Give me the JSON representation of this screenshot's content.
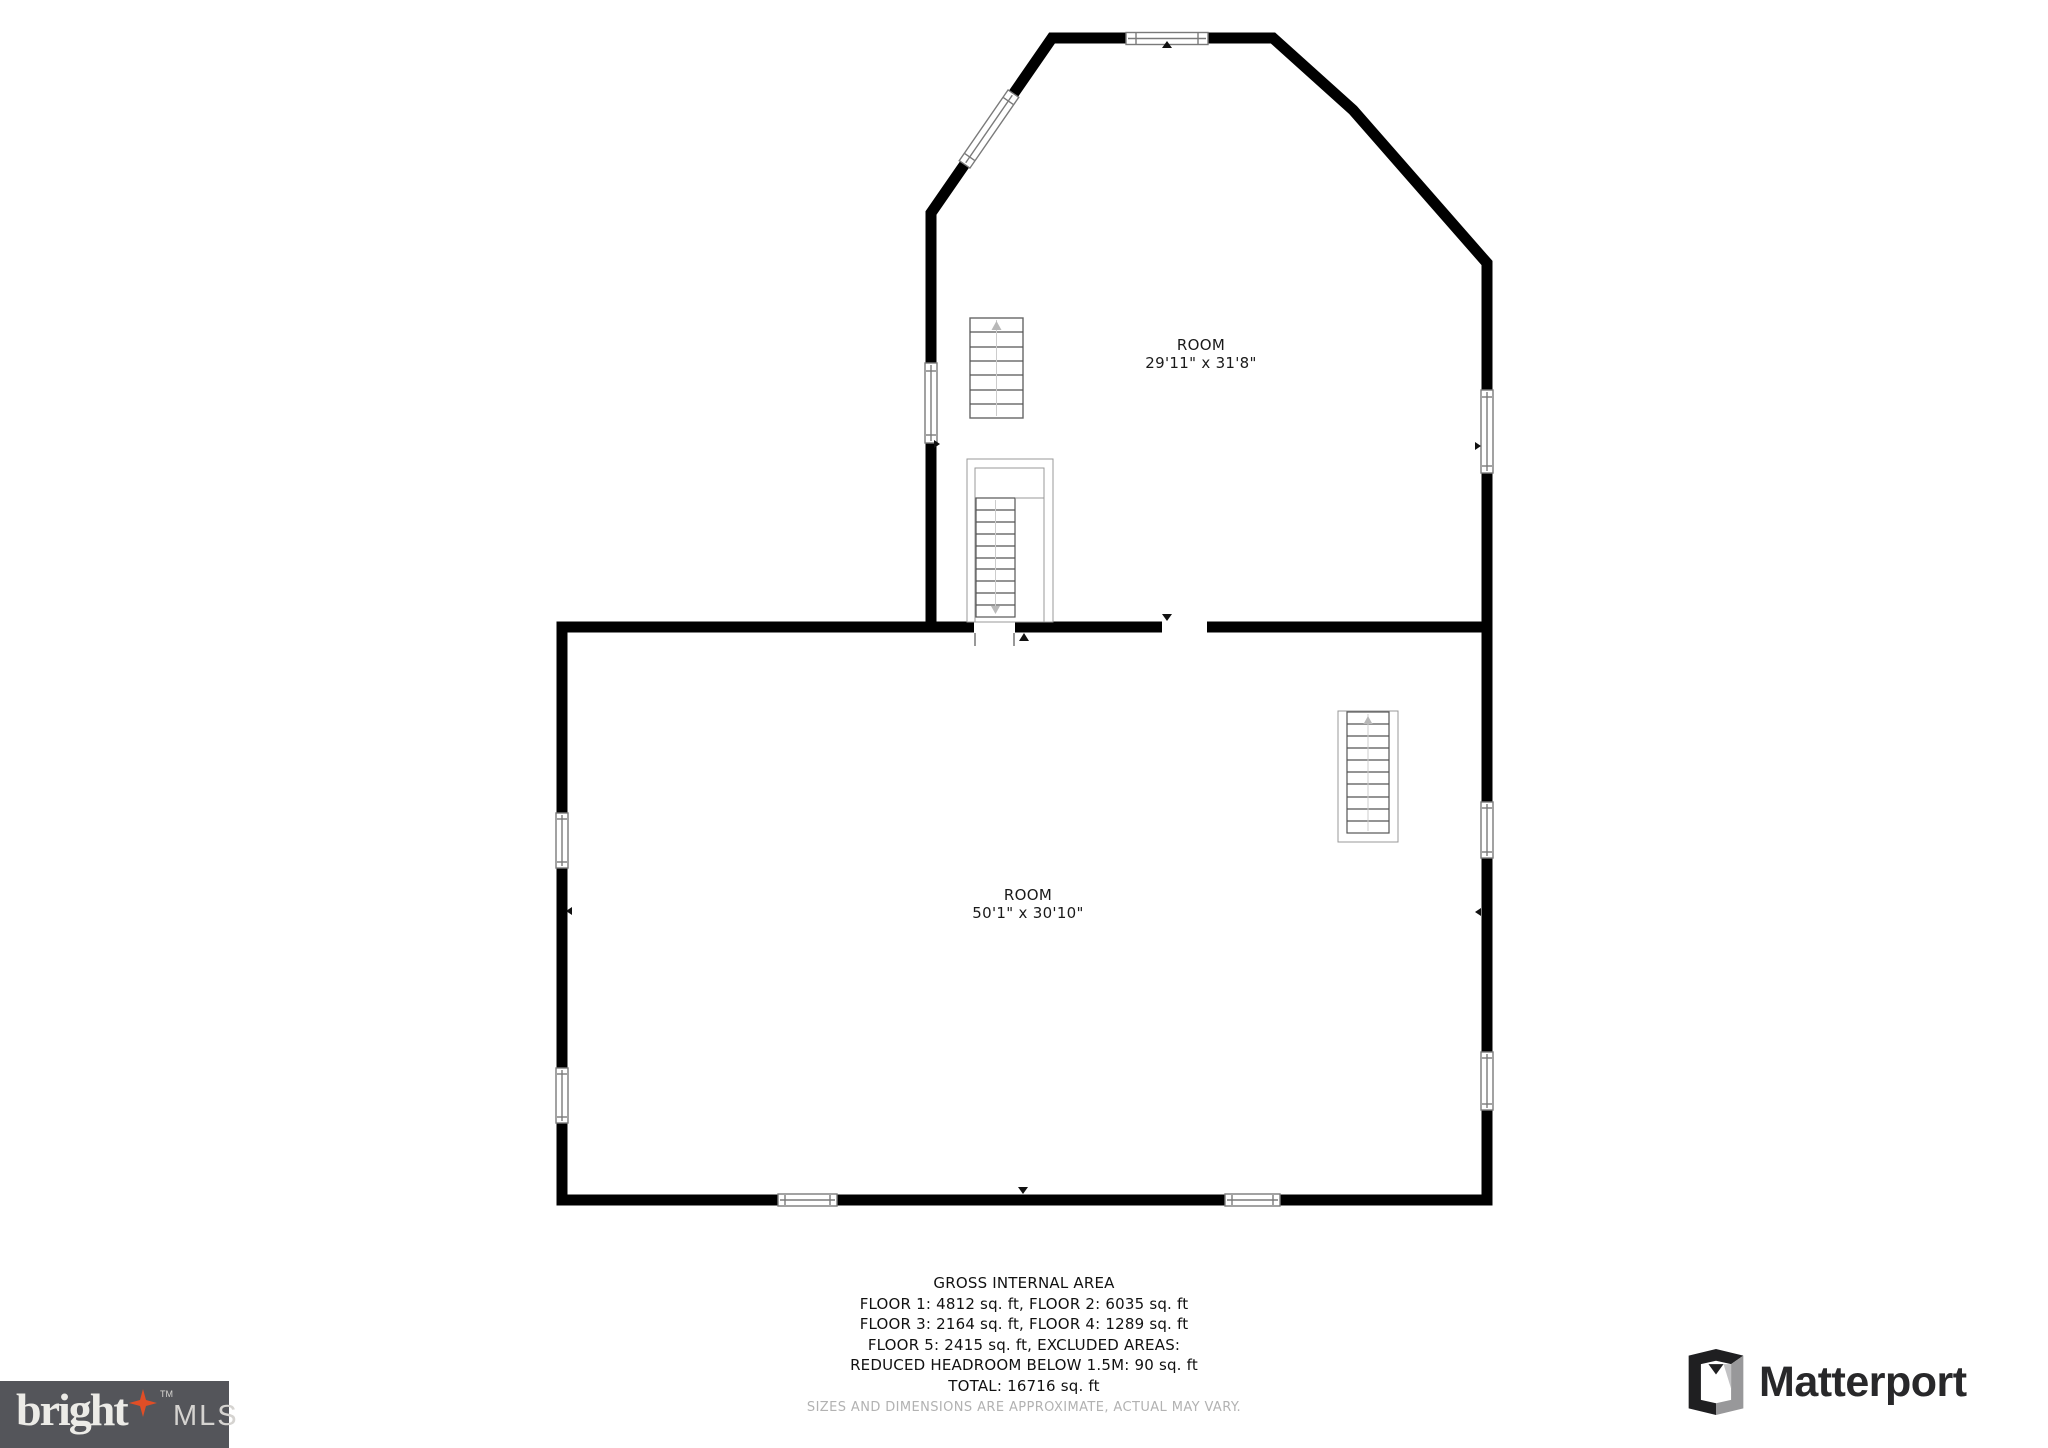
{
  "floorplan": {
    "rooms": [
      {
        "name": "ROOM",
        "dims": "29'11\" x 31'8\""
      },
      {
        "name": "ROOM",
        "dims": "50'1\" x 30'10\""
      }
    ],
    "footer": {
      "title": "GROSS INTERNAL AREA",
      "line1": "FLOOR 1: 4812 sq. ft, FLOOR 2: 6035 sq. ft",
      "line2": "FLOOR 3: 2164 sq. ft, FLOOR 4: 1289 sq. ft",
      "line3": "FLOOR 5: 2415 sq. ft, EXCLUDED AREAS:",
      "line4": "REDUCED HEADROOM BELOW 1.5M: 90 sq. ft",
      "total": "TOTAL: 16716 sq. ft",
      "disclaimer": "SIZES AND DIMENSIONS ARE APPROXIMATE, ACTUAL MAY VARY."
    },
    "areas": {
      "floor1_sqft": 4812,
      "floor2_sqft": 6035,
      "floor3_sqft": 2164,
      "floor4_sqft": 1289,
      "floor5_sqft": 2415,
      "excluded_reduced_headroom_below_1_5m_sqft": 90,
      "total_sqft": 16716
    }
  },
  "branding": {
    "bright": {
      "word": "bright",
      "tm": "TM",
      "suffix": "MLS",
      "bg_color": "#54555A",
      "star_color": "#E04E26",
      "text_color": "#ECEBE7"
    },
    "matterport": {
      "word": "Matterport",
      "text_color": "#28282A"
    }
  },
  "colors": {
    "wall": "#000000",
    "background": "#FFFFFF",
    "window_frame": "#7a7a7a",
    "stair_line": "#555555",
    "label_text": "#1A1A1A",
    "disclaimer_text": "#B2B2B2"
  }
}
